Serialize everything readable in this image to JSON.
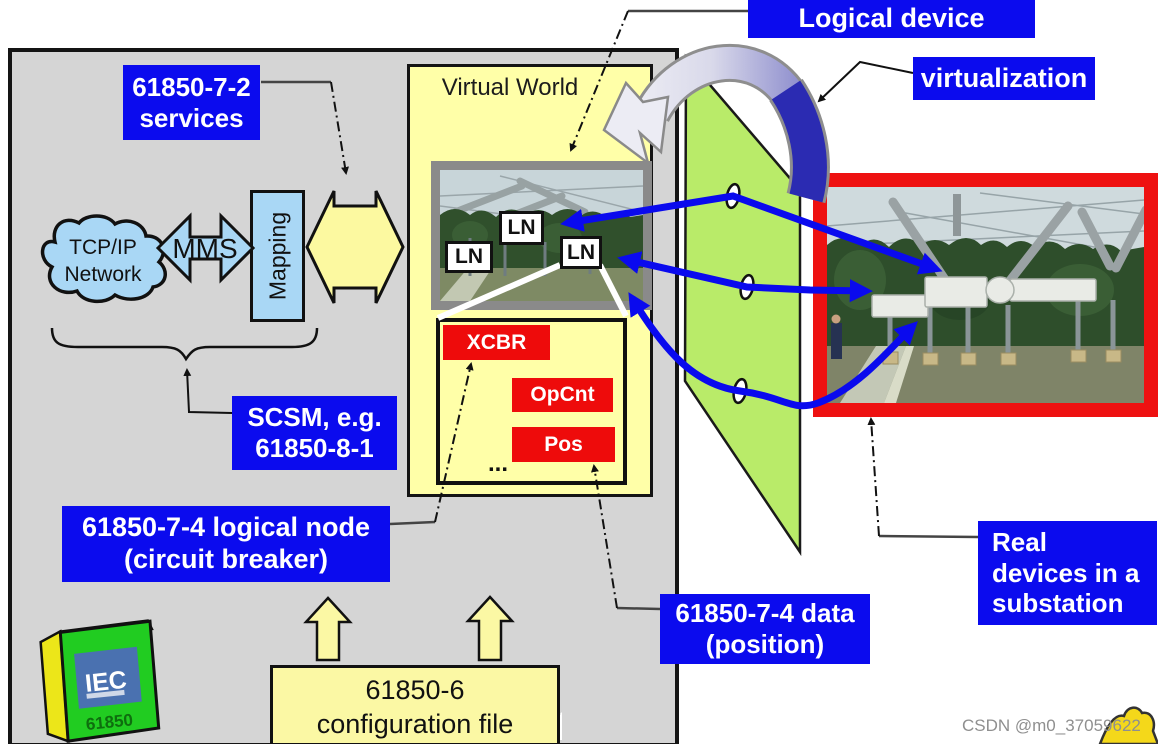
{
  "labels": {
    "logical_device": "Logical device",
    "virtualization": "virtualization",
    "services_1": "61850-7-2",
    "services_2": "services",
    "scsm_1": "SCSM, e.g.",
    "scsm_2": "61850-8-1",
    "logical_node_1": "61850-7-4 logical node",
    "logical_node_2": "(circuit breaker)",
    "data_position_1": "61850-7-4 data",
    "data_position_2": "(position)",
    "real_devices_1": "Real",
    "real_devices_2": "devices in a",
    "real_devices_3": "substation"
  },
  "virtual_world": {
    "title": "Virtual World",
    "ln": "LN",
    "xcbr": "XCBR",
    "opcnt": "OpCnt",
    "pos": "Pos",
    "ellipsis": "..."
  },
  "network": {
    "cloud_1": "TCP/IP",
    "cloud_2": "Network",
    "mms": "MMS",
    "mapping": "Mapping"
  },
  "config_file": {
    "line1": "61850-6",
    "line2": "configuration file"
  },
  "book": {
    "title": "IEC",
    "subtitle": "61850"
  },
  "watermark": "CSDN @m0_37059622",
  "colors": {
    "label_blue": "#0b0bee",
    "node_red": "#ee0b0b",
    "panel_gray": "#d5d5d5",
    "world_yellow": "#ffffa8",
    "plane_green": "#b9eb69",
    "network_blue": "#a9d7f5",
    "arrow_blue": "#0a0aee",
    "photo_frame_red": "#ee1111"
  }
}
